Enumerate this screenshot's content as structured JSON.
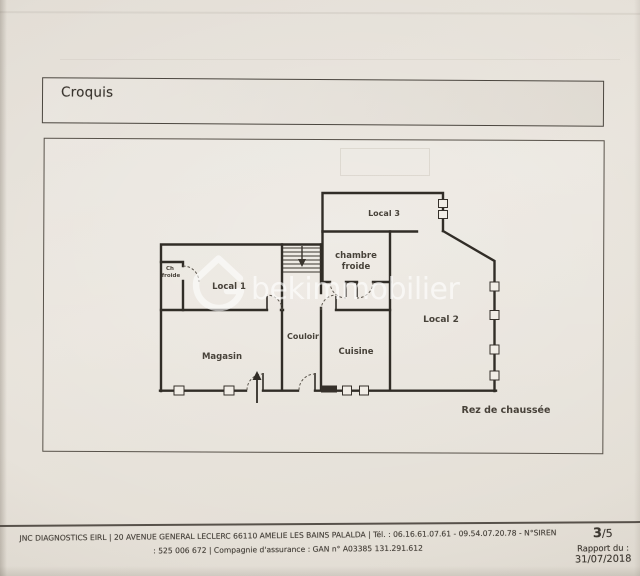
{
  "document": {
    "section_title": "Croquis",
    "floor_label": "Rez de chaussée",
    "watermark_text": "bekimmobilier"
  },
  "plan": {
    "rooms": {
      "local1": "Local 1",
      "local2": "Local 2",
      "local3": "Local 3",
      "chambre_froide_line1": "chambre",
      "chambre_froide_line2": "froide",
      "closet_line1": "Ch",
      "closet_line2": "froide",
      "couloir": "Couloir",
      "cuisine": "Cuisine",
      "magasin": "Magasin"
    }
  },
  "footer": {
    "company_line1": "JNC DIAGNOSTICS EIRL | 20 AVENUE GENERAL LECLERC 66110 AMELIE LES BAINS PALALDA | Tél. : 06.16.61.07.61 - 09.54.07.20.78 - N°SIREN",
    "company_line2": ": 525 006 672 | Compagnie d'assurance : GAN n° A03385 131.291.612",
    "page_current": "3",
    "page_total": "/5",
    "report_label": "Rapport du :",
    "report_date": "31/07/2018"
  },
  "colors": {
    "paper": "#e6e1d9",
    "wall_ink": "#312d27",
    "watermark": "#ffffff"
  }
}
